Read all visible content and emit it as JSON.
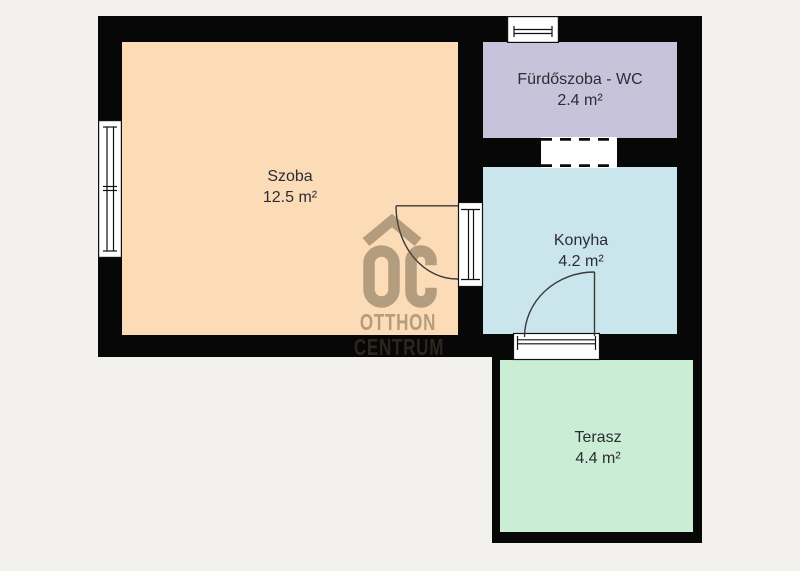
{
  "plan": {
    "type": "floor-plan",
    "watermark": {
      "line1": "OTTHON",
      "line2": "CENTRUM",
      "logo": "OC",
      "color": "rgba(94,78,58,0.45)"
    },
    "colors": {
      "background": "#f2f1ed",
      "wall": "#070707",
      "opening": "#ffffff",
      "label_text": "#2c2c35"
    },
    "rooms": {
      "szoba": {
        "name": "Szoba",
        "area": "12.5 m²",
        "color": "#fbdcb7"
      },
      "furdoszoba": {
        "name": "Fürdőszoba - WC",
        "area": "2.4 m²",
        "color": "#c7c3db"
      },
      "konyha": {
        "name": "Konyha",
        "area": "4.2 m²",
        "color": "#cbe5ec"
      },
      "terasz": {
        "name": "Terasz",
        "area": "4.4 m²",
        "color": "#c9eed3"
      }
    },
    "features": [
      "window-west",
      "window-north",
      "open-passage-bathroom-kitchen",
      "door-szoba-konyha",
      "door-konyha-terasz"
    ]
  }
}
